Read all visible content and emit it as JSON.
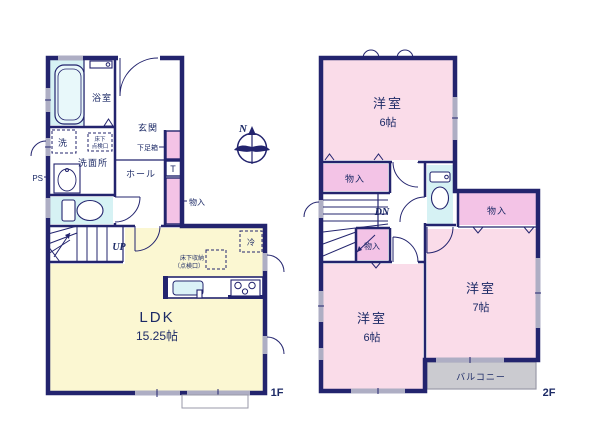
{
  "colors": {
    "wall_navy": "#23246e",
    "label_navy": "#1c2a66",
    "ldk_yellow": "#fbf7d2",
    "bedroom_pink": "#fadce9",
    "closet_pink": "#f3c3e6",
    "wet_area_cyan": "#d6f2f4",
    "balcony_gray": "#cbcbd0",
    "window_gray": "#aeaec4"
  },
  "compass": {
    "north": "N"
  },
  "floor1": {
    "floor_label": "1F",
    "bathroom": "浴室",
    "laundry": "洗",
    "washroom": "洗面所",
    "pipe_space": "PS",
    "entrance": "玄関",
    "shoe_cabinet": "下足箱",
    "t_marker": "T",
    "hall": "ホール",
    "closet": "物入",
    "stairs_up": "UP",
    "underfloor_hatch_line1": "床下",
    "underfloor_hatch_line2": "点検口",
    "refrigerator": "冷",
    "underfloor_storage_line1": "床下収納",
    "underfloor_storage_line2": "（点検口）",
    "ldk": "LDK",
    "ldk_size": "15.25帖"
  },
  "floor2": {
    "floor_label": "2F",
    "bedroom_north": "洋室",
    "bedroom_north_size": "6帖",
    "closet_north": "物入",
    "stairs_down": "DN",
    "closet_center": "物入",
    "closet_east": "物入",
    "bedroom_east": "洋室",
    "bedroom_east_size": "7帖",
    "bedroom_south": "洋室",
    "bedroom_south_size": "6帖",
    "balcony": "バルコニー"
  }
}
